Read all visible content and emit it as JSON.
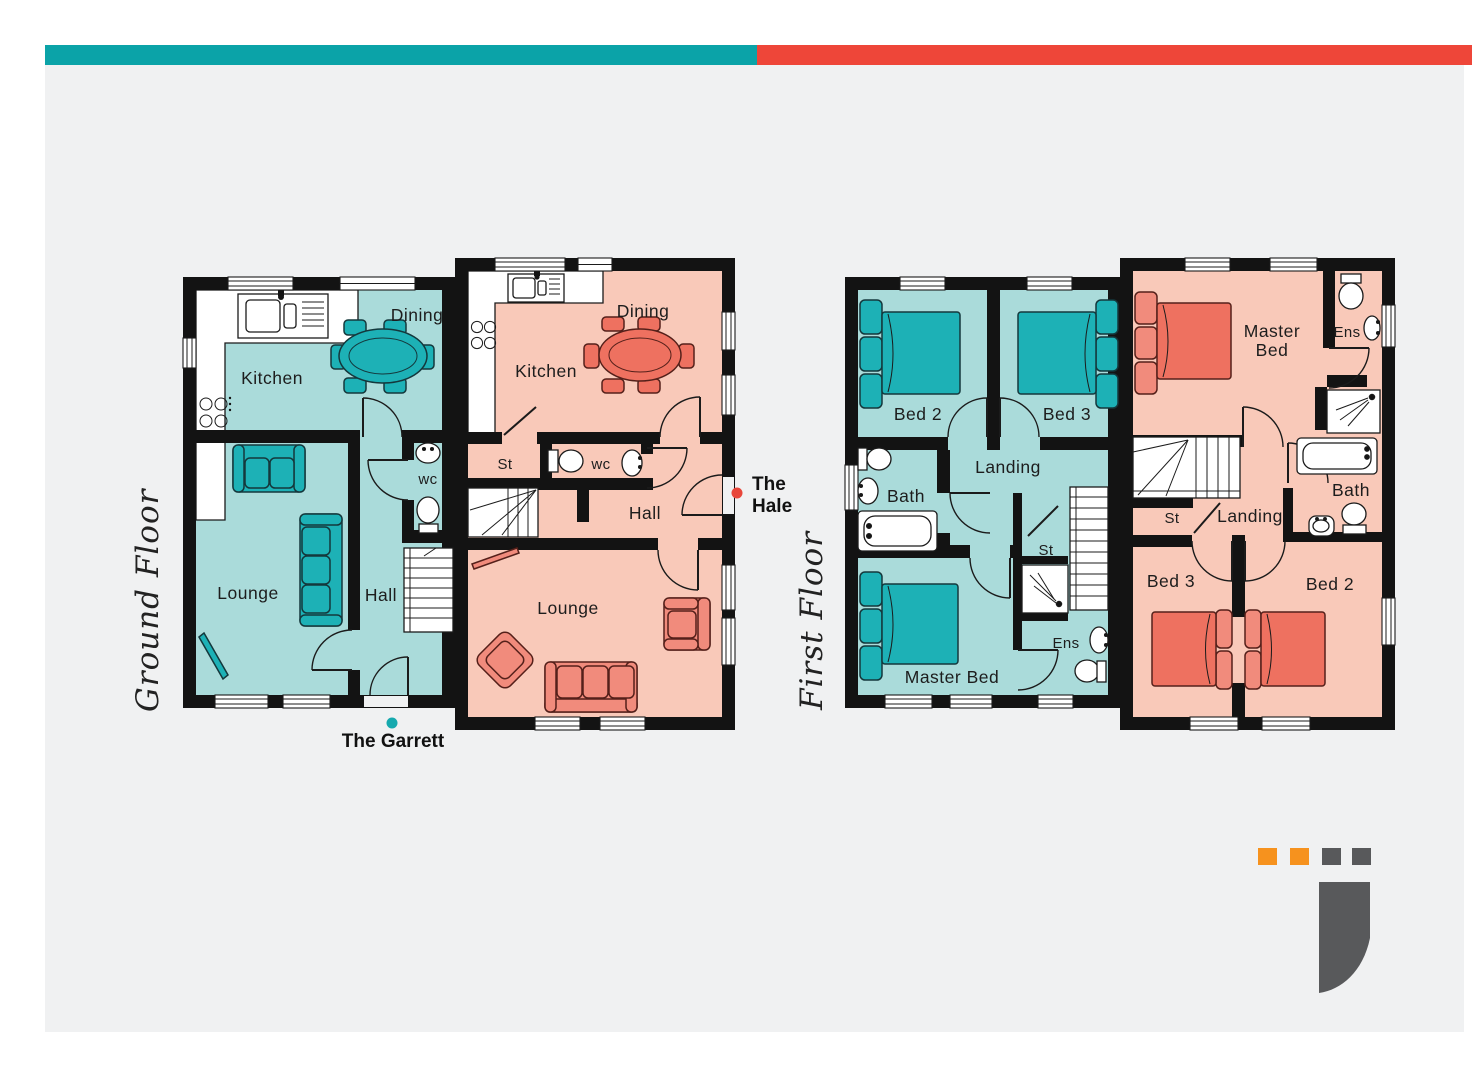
{
  "banner": {
    "teal": "#0ba3a8",
    "red": "#ee4639"
  },
  "background": "#f0f1f2",
  "floor_titles": {
    "ground": "Ground Floor",
    "first": "First Floor"
  },
  "houses": {
    "garrett": {
      "name": "The Garrett",
      "marker": "#16a9ae",
      "floor_fill": "#aadbda",
      "furniture": "#1db1b6"
    },
    "hale": {
      "name_line1": "The",
      "name_line2": "Hale",
      "marker": "#e8463a",
      "floor_fill": "#f9c9b9",
      "furniture": "#f18b7c",
      "accent": "#ee7160"
    }
  },
  "rooms": {
    "ground_garrett": {
      "kitchen": "Kitchen",
      "dining": "Dining",
      "lounge": "Lounge",
      "hall": "Hall",
      "wc": "wc"
    },
    "ground_hale": {
      "kitchen": "Kitchen",
      "dining": "Dining",
      "st": "St",
      "wc": "wc",
      "hall": "Hall",
      "lounge": "Lounge"
    },
    "first_garrett": {
      "bed2": "Bed 2",
      "bed3": "Bed 3",
      "landing": "Landing",
      "bath": "Bath",
      "master": "Master Bed",
      "st": "St",
      "ens": "Ens"
    },
    "first_hale": {
      "master_line1": "Master",
      "master_line2": "Bed",
      "ens": "Ens",
      "bath": "Bath",
      "st": "St",
      "landing": "Landing",
      "bed3": "Bed 3",
      "bed2": "Bed 2"
    }
  },
  "logo": {
    "orange": "#f6921e",
    "gray": "#58595b"
  }
}
